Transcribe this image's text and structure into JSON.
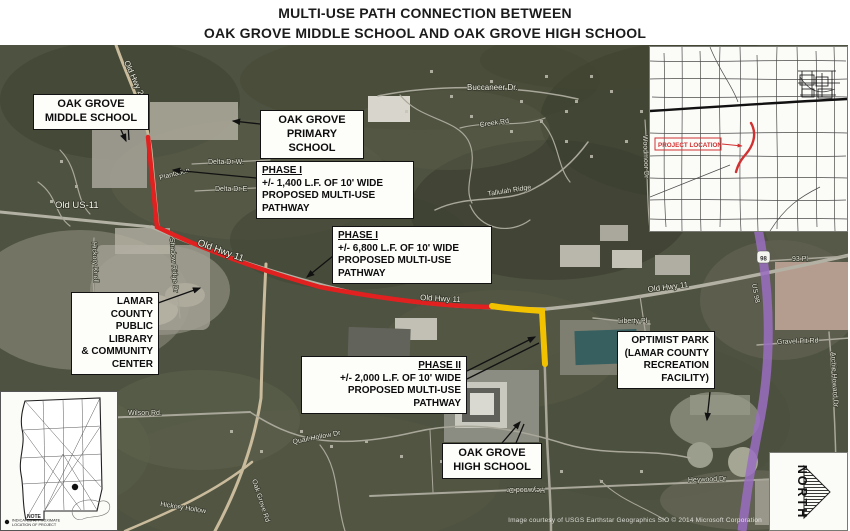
{
  "title": {
    "line1": "MULTI-USE PATH CONNECTION BETWEEN",
    "line2": "OAK GROVE MIDDLE SCHOOL AND OAK GROVE HIGH SCHOOL"
  },
  "callouts": {
    "middle_school": {
      "line1": "OAK GROVE",
      "line2": "MIDDLE SCHOOL"
    },
    "primary_school": {
      "line1": "OAK GROVE",
      "line2": "PRIMARY SCHOOL"
    },
    "phase1a": {
      "heading": "PHASE I",
      "line1": "+/- 1,400 L.F. OF 10' WIDE",
      "line2": "PROPOSED MULTI-USE PATHWAY"
    },
    "phase1b": {
      "heading": "PHASE I",
      "line1": "+/- 6,800 L.F. OF 10' WIDE",
      "line2": "PROPOSED MULTI-USE PATHWAY"
    },
    "library": {
      "line1": "LAMAR COUNTY",
      "line2": "PUBLIC LIBRARY",
      "line3": "& COMMUNITY",
      "line4": "CENTER"
    },
    "phase2": {
      "heading": "PHASE II",
      "line1": "+/- 2,000 L.F. OF 10' WIDE",
      "line2": "PROPOSED MULTI-USE PATHWAY"
    },
    "high_school": {
      "line1": "OAK GROVE",
      "line2": "HIGH SCHOOL"
    },
    "optimist_park": {
      "line1": "OPTIMIST PARK",
      "line2": "(LAMAR COUNTY",
      "line3": "RECREATION",
      "line4": "FACILITY)"
    }
  },
  "insets": {
    "project_location": {
      "label": "PROJECT LOCATION"
    },
    "state_map": {
      "note_heading": "NOTE",
      "note_line1": "INDICATED APPROXIMATE",
      "note_line2": "LOCATION OF PROJECT"
    },
    "north_arrow": {
      "label": "NORTH"
    }
  },
  "streets": [
    "Old Hwy 24",
    "Buccaneer Dr.",
    "Old US-11",
    "Old Hwy 11",
    "Shadow Ridge Dr",
    "Hickory Knoll",
    "Plantation",
    "Delta Dr W.",
    "Delta Dr E",
    "Tallulah Ridge",
    "Liberty Pl",
    "93 Pl",
    "Gravel Pit Rd",
    "Archie Howard Dr",
    "US 98",
    "Wilson Rd.",
    "Quail Hollow Dr",
    "Oak Grove Rd",
    "Hickory Hollow",
    "Heywood Dr",
    "Creek Rd",
    "Woodmoor Dr",
    "98"
  ],
  "attribution": "Image courtesy of USGS Earthstar Geographics SIO © 2014 Microsoft Corporation",
  "colors": {
    "phase1_route": "#e12020",
    "phase2_route": "#f2c200",
    "highway_us98": "#9a6dc1",
    "project_location": "#d23131"
  }
}
